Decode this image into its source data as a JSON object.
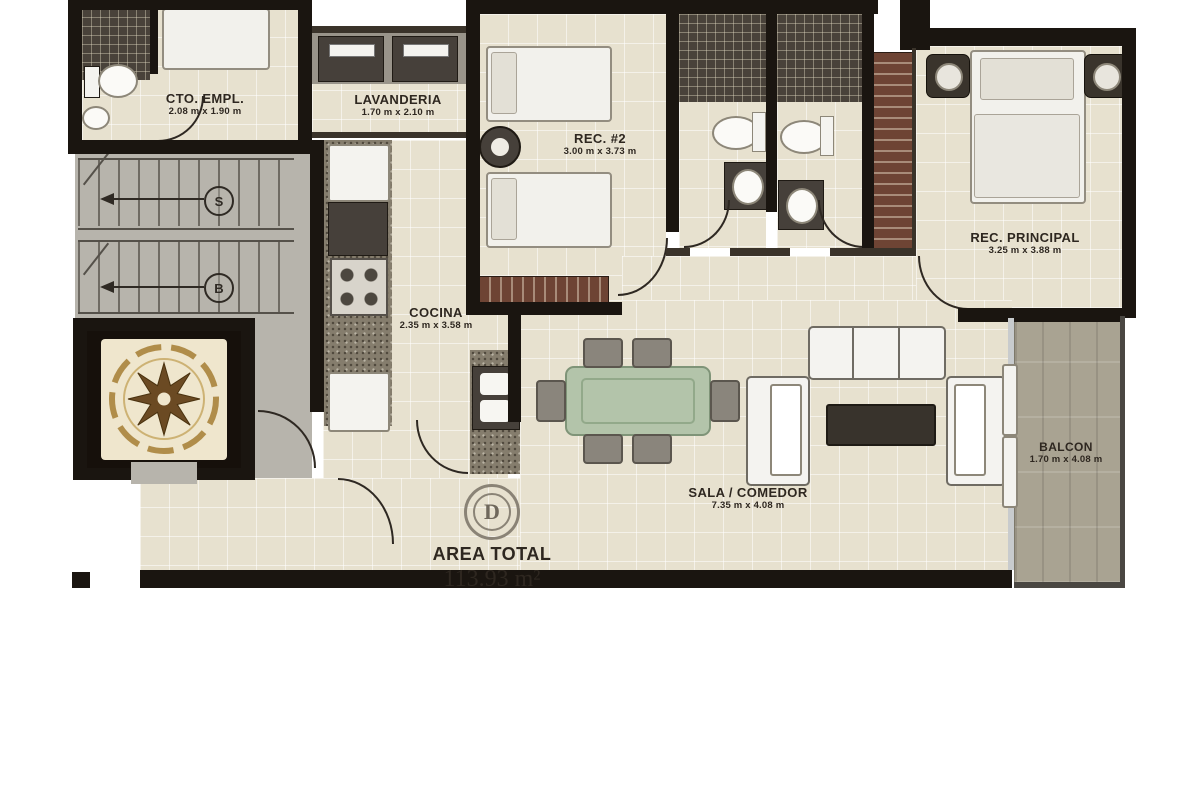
{
  "plan": {
    "badge": "D",
    "area_total": {
      "label": "AREA TOTAL",
      "value": "113.93 m²"
    },
    "stairs": {
      "up_label": "S",
      "down_label": "B"
    },
    "rooms": [
      {
        "id": "cto-empl",
        "name": "CTO. EMPL.",
        "dims": "2.08 m x 1.90 m"
      },
      {
        "id": "lavanderia",
        "name": "LAVANDERIA",
        "dims": "1.70 m x 2.10 m"
      },
      {
        "id": "rec-2",
        "name": "REC. #2",
        "dims": "3.00 m x 3.73 m"
      },
      {
        "id": "rec-principal",
        "name": "REC. PRINCIPAL",
        "dims": "3.25 m x 3.88 m"
      },
      {
        "id": "cocina",
        "name": "COCINA",
        "dims": "2.35 m x 3.58 m"
      },
      {
        "id": "sala-comedor",
        "name": "SALA / COMEDOR",
        "dims": "7.35 m x 4.08 m"
      },
      {
        "id": "balcon",
        "name": "BALCON",
        "dims": "1.70 m x 4.08 m"
      }
    ],
    "colors": {
      "floor_tile": "#e7e1cf",
      "common_floor": "#b7b4ac",
      "wall": "#1a1510",
      "closet_wood": "#6e4434",
      "balcony_floor": "#a9a392",
      "dining_table": "#b3c4aa",
      "compass_gold": "#b08d4a",
      "label_text": "#2e2720"
    }
  }
}
